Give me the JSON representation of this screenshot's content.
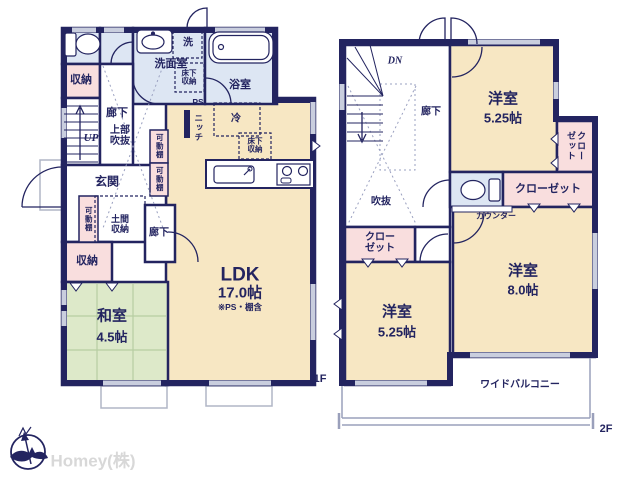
{
  "f1": {
    "floor": "1F",
    "storage_a": "収納",
    "hall_a": "廊下",
    "up": "UP",
    "open_above": "上部\n吹抜",
    "washroom": "洗面室",
    "washer": "洗",
    "underfloor_a": "床下\n収納",
    "bathroom": "浴室",
    "ps": "PS",
    "niche": "ニッチ",
    "fridge": "冷",
    "underfloor_b": "床下\n収納",
    "shelf_a": "可動棚",
    "shelf_b": "可動棚",
    "shelf_c": "可動棚",
    "entrance": "玄関",
    "doma": "土間\n収納",
    "storage_b": "収納",
    "hall_b": "廊下",
    "washitsu": "和室",
    "washitsu_size": "4.5帖",
    "ldk": "LDK",
    "ldk_size": "17.0帖",
    "ldk_note": "※PS・棚含"
  },
  "f2": {
    "floor": "2F",
    "dn": "DN",
    "hall": "廊下",
    "void": "吹抜",
    "bed_a": "洋室",
    "bed_a_size": "5.25帖",
    "closet_a": "クロー\nゼット",
    "closet_b": "クローゼット",
    "counter": "カウンター",
    "closet_c": "クロー\nゼット",
    "bed_b": "洋室",
    "bed_b_size": "5.25帖",
    "bed_c": "洋室",
    "bed_c_size": "8.0帖",
    "balcony": "ワイドバルコニー"
  },
  "brand": {
    "watermark": "Homey(株)"
  },
  "colors": {
    "wall": "#232460",
    "room_cream": "#f7e7c3",
    "room_blue": "#dde6f3",
    "room_pink": "#f9dede",
    "room_green": "#dde9c9",
    "window": "#c9cede",
    "watermark": "#d8d8d8"
  }
}
